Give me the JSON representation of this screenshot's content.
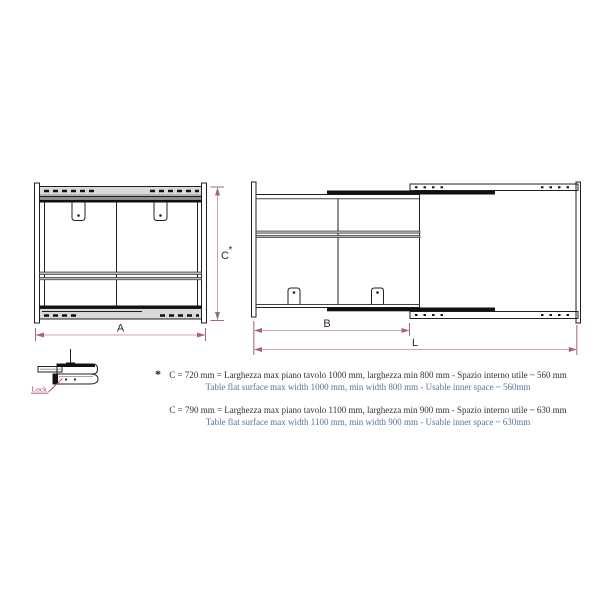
{
  "drawing": {
    "closed_view": {
      "width_label": "A",
      "height_label": "C",
      "height_star": "*"
    },
    "extended_view": {
      "inner_width_label": "B",
      "total_length_label": "L"
    },
    "lock_detail": {
      "label": "Lock"
    }
  },
  "notes": [
    {
      "marker": "*",
      "it": "C = 720 mm = Larghezza max piano tavolo 1000 mm, larghezza min 800 mm - Spazio interno utile ~ 560 mm",
      "en": "Table flat surface max width 1000 mm, min width 800 mm - Usable inner space ~ 560mm"
    },
    {
      "marker": "",
      "it": "C = 790 mm = Larghezza max piano tavolo 1100 mm, larghezza min 900 mm - Spazio interno utile ~ 630 mm",
      "en": "Table flat surface max width 1100 mm, min width 900 mm - Usable inner space ~ 630mm"
    }
  ],
  "colors": {
    "dimension_line": "#cfa4b6",
    "dimension_accent": "#a4647e",
    "lock_label": "#b2426b",
    "note_italian": "#34332f",
    "note_english": "#56749f",
    "drawing_line": "#1f1f1f",
    "rail_fill": "#d9d9d9"
  }
}
